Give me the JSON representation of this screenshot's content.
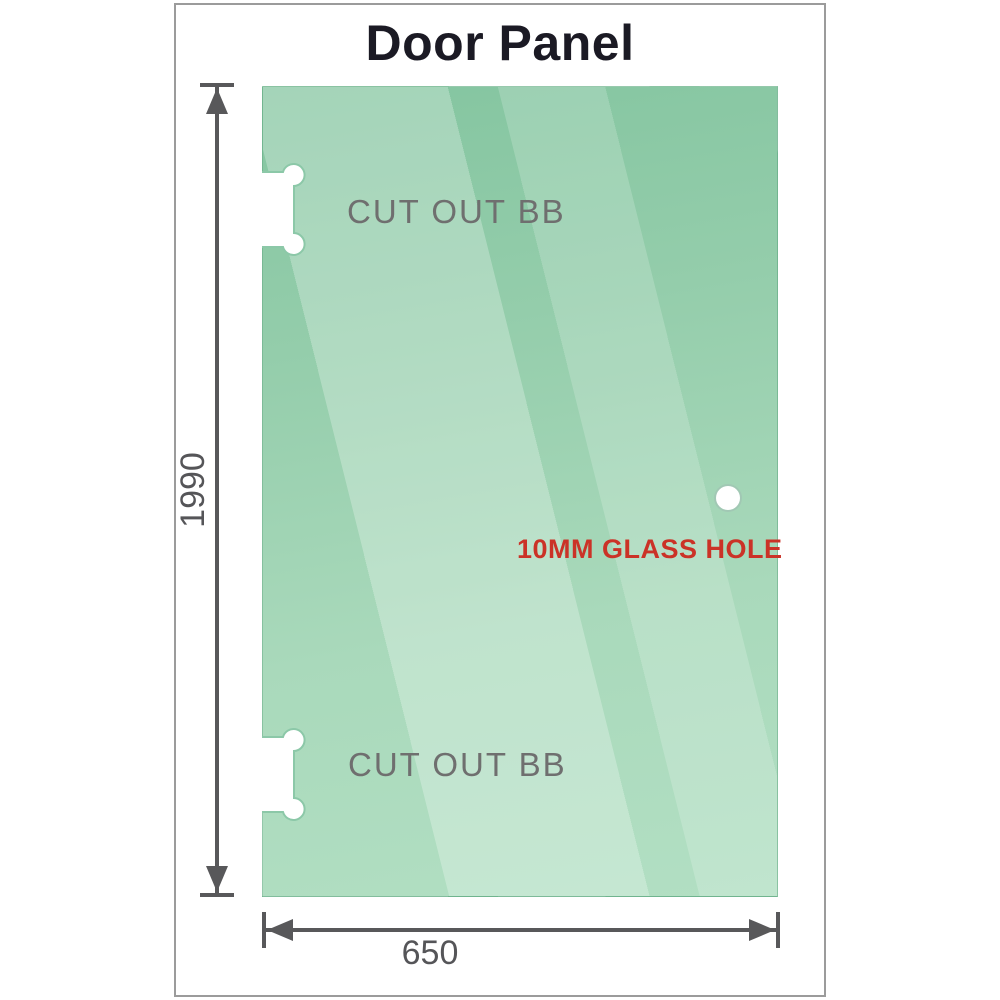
{
  "title": "Door Panel",
  "panel": {
    "top_cutout_label": "CUT OUT BB",
    "bottom_cutout_label": "CUT OUT BB",
    "hole_label": "10MM GLASS HOLE"
  },
  "dimensions": {
    "height_mm": "1990",
    "width_mm": "650"
  },
  "colors": {
    "glass_green_dark": "#84c5a0",
    "glass_green_light": "#b2dfc3",
    "glass_sheen": "rgba(255,255,255,0.26)",
    "dimension_gray": "#58585a",
    "cutout_label_gray": "#6f6f6f",
    "hole_label_red": "#cb3227",
    "title_color": "#1b1a24",
    "card_border_gray": "#9b9b9b"
  }
}
